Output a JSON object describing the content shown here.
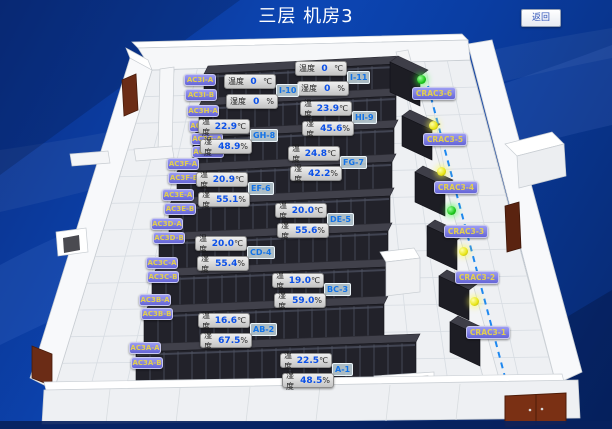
{
  "header": {
    "title": "三层 机房3",
    "back_button": "返回"
  },
  "ui": {
    "temp_label": "温度",
    "temp_unit": "℃",
    "hum_label": "湿度",
    "hum_unit": "%"
  },
  "colors": {
    "value_blue": "#0b50e8",
    "label_purple": "#7b7be4",
    "label_text_yellow": "#e3cf4e",
    "status_green": "#1bc81b",
    "status_yellow": "#e8e514",
    "dashed_line_blue": "#1e88f0"
  },
  "rack_labels": [
    "AC3I-A",
    "AC3I-B",
    "AC3H-A",
    "AC3H-B",
    "AC3G-A",
    "AC3G-B",
    "AC3F-A",
    "AC3F-B",
    "AC3E-A",
    "AC3E-B",
    "AC3D-A",
    "AC3D-B",
    "AC3C-A",
    "AC3C-B",
    "AC3B-A",
    "AC3B-B",
    "AC3A-A",
    "AC3A-B"
  ],
  "crac_units": [
    {
      "label": "CRAC3-6",
      "status": "green"
    },
    {
      "label": "CRAC3-5",
      "status": "yellow"
    },
    {
      "label": "CRAC3-4",
      "status": "yellow"
    },
    {
      "label": "CRAC3-3",
      "status": "green"
    },
    {
      "label": "CRAC3-2",
      "status": "yellow"
    },
    {
      "label": "CRAC3-1",
      "status": "yellow"
    }
  ],
  "sensors": [
    {
      "aisle": "I-11",
      "temp": "0",
      "hum": "0"
    },
    {
      "aisle": "I-10",
      "temp": "0",
      "hum": "0"
    },
    {
      "aisle": "HI-9",
      "temp": "23.9",
      "hum": "45.6"
    },
    {
      "aisle": "GH-8",
      "temp": "22.9",
      "hum": "48.9"
    },
    {
      "aisle": "FG-7",
      "temp": "24.8",
      "hum": "42.2"
    },
    {
      "aisle": "EF-6",
      "temp": "20.9",
      "hum": "55.1"
    },
    {
      "aisle": "DE-5",
      "temp": "20.0",
      "hum": "55.6"
    },
    {
      "aisle": "CD-4",
      "temp": "20.0",
      "hum": "55.4"
    },
    {
      "aisle": "BC-3",
      "temp": "19.0",
      "hum": "59.0"
    },
    {
      "aisle": "AB-2",
      "temp": "16.6",
      "hum": "67.5"
    },
    {
      "aisle": "A-1",
      "temp": "22.5",
      "hum": "48.5"
    }
  ]
}
